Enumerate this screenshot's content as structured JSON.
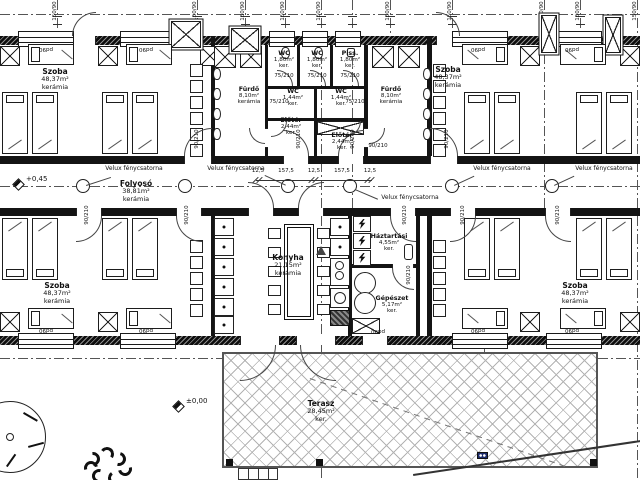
{
  "rooms": {
    "szoba_tl": {
      "name": "Szoba",
      "area": "48,37m²",
      "floor": "kerámia"
    },
    "szoba_tr": {
      "name": "Szoba",
      "area": "48,37m²",
      "floor": "kerámia"
    },
    "szoba_bl": {
      "name": "Szoba",
      "area": "48,37m²",
      "floor": "kerámia"
    },
    "szoba_br": {
      "name": "Szoba",
      "area": "48,37m²",
      "floor": "kerámia"
    },
    "furdo_l": {
      "name": "Fürdő",
      "area": "8,10m²",
      "floor": "kerámia"
    },
    "furdo_r": {
      "name": "Fürdő",
      "area": "8,10m²",
      "floor": "kerámia"
    },
    "wc_1": {
      "name": "WC",
      "area": "1,80m²",
      "floor": "ker."
    },
    "wc_2": {
      "name": "WC",
      "area": "1,80m²",
      "floor": "ker."
    },
    "piss": {
      "name": "Piss.",
      "area": "1,80m²",
      "floor": "ker."
    },
    "wc_small_l": {
      "name": "WC",
      "area": "1,44m²",
      "floor": "ker."
    },
    "wc_small_r": {
      "name": "WC",
      "area": "1,44m²",
      "floor": "ker."
    },
    "eloter_l": {
      "name": "Előtér",
      "area": "2,44m²",
      "floor": "ker."
    },
    "eloter_r": {
      "name": "Előtér",
      "area": "2,44m²",
      "floor": "ker."
    },
    "folyoso": {
      "name": "Folyosó",
      "area": "38,81m²",
      "floor": "kerámia"
    },
    "konyha": {
      "name": "Konyha",
      "area": "21,15m²",
      "floor": "kerámia"
    },
    "haztartasi": {
      "name": "Háztartási",
      "area": "4,55m²",
      "floor": "ker."
    },
    "gepeszet": {
      "name": "Gépészet",
      "area": "5,17m²",
      "floor": "ker."
    },
    "terasz": {
      "name": "Terasz",
      "area": "28,45m²",
      "floor": "ker."
    }
  },
  "annotations": {
    "velux": "Velux fénycsatorna",
    "level_corridor": "+0,45",
    "level_ground": "±0,00",
    "door_tag_small": "75/210",
    "door_tag_large": "90/210",
    "window_tag": "pd90",
    "grid_dim_tag": "150/90",
    "dims": [
      "12,5",
      "157,5",
      "12,5",
      "157,5",
      "12,5"
    ]
  }
}
